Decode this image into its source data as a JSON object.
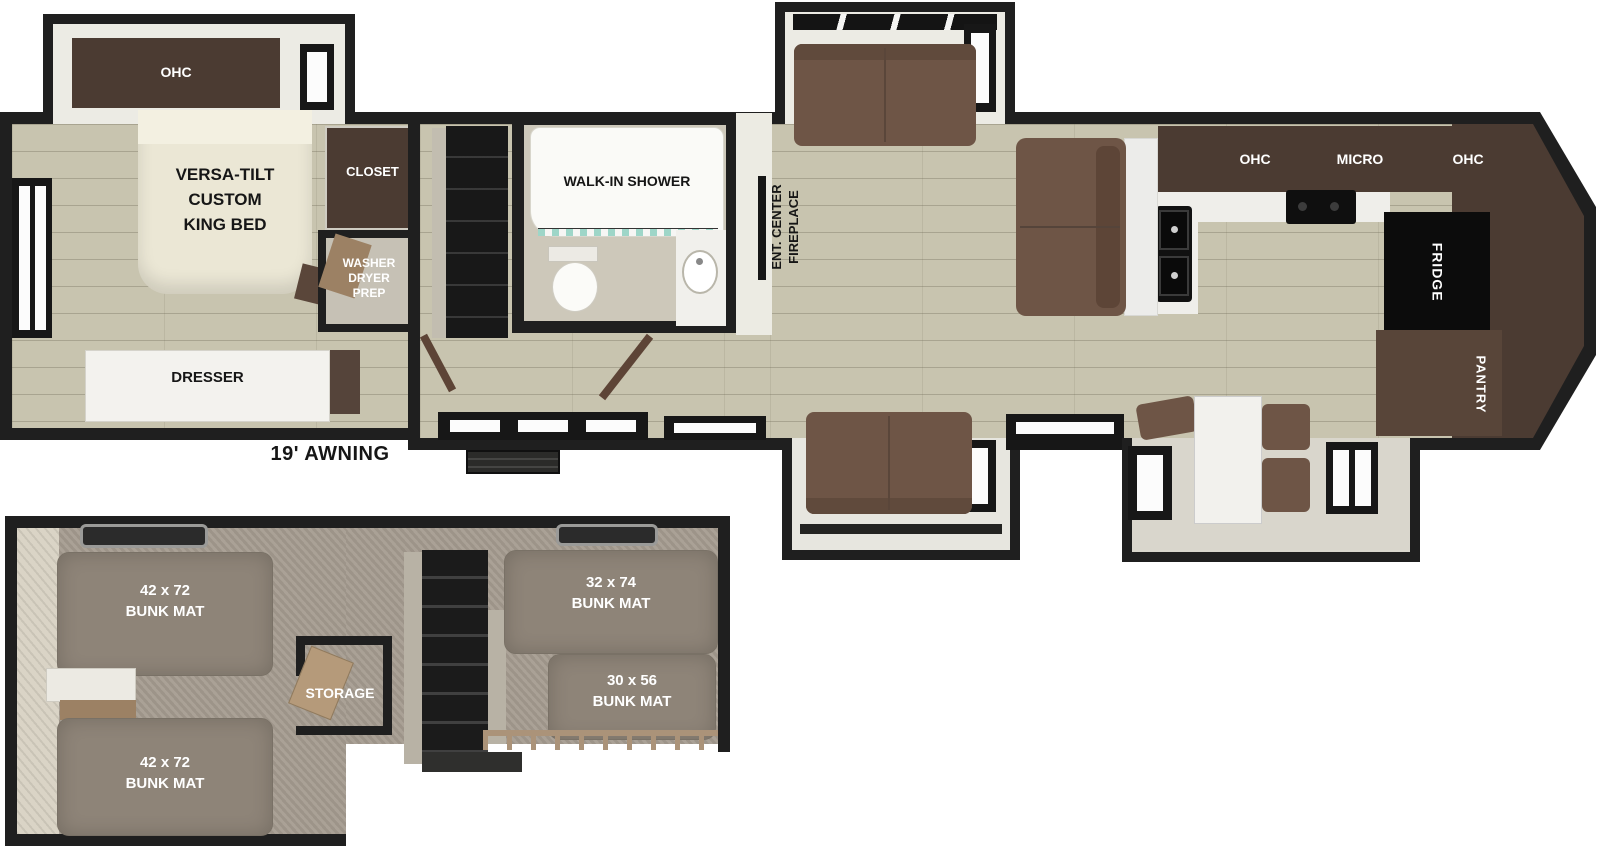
{
  "meta": {
    "title": "RV floor plan with bunk loft",
    "width_px": 1600,
    "height_px": 848
  },
  "palette": {
    "wall": "#1f1f1f",
    "floor_wood": "#c8c4af",
    "bunk_floor": "#a59c90",
    "cabinet_brown": "#4b3b32",
    "sofa_brown": "#6e5546",
    "bunk_mat": "#8e8478",
    "accent_wood": "#ab9379",
    "curtain_teal": "#9ed6c8"
  },
  "main_floor": {
    "awning": "19' AWNING",
    "bedroom": {
      "ohc": "OHC",
      "bed": [
        "VERSA-TILT",
        "CUSTOM",
        "KING BED"
      ],
      "closet": "CLOSET",
      "washer": [
        "WASHER",
        "DRYER",
        "PREP"
      ],
      "dresser": "DRESSER"
    },
    "bathroom": {
      "shower": "WALK-IN SHOWER"
    },
    "living": {
      "ent_center": [
        "ENT. CENTER",
        "FIREPLACE"
      ]
    },
    "kitchen": {
      "ohc_left": "OHC",
      "micro": "MICRO",
      "ohc_right": "OHC",
      "fridge": "FRIDGE",
      "pantry": "PANTRY"
    }
  },
  "bunk_room": {
    "bunk_front_top": [
      "42 x 72",
      "BUNK MAT"
    ],
    "bunk_front_bottom": [
      "42 x 72",
      "BUNK MAT"
    ],
    "bunk_rear_top": [
      "32 x 74",
      "BUNK MAT"
    ],
    "bunk_rear_bottom": [
      "30 x 56",
      "BUNK MAT"
    ],
    "storage": "STORAGE"
  }
}
